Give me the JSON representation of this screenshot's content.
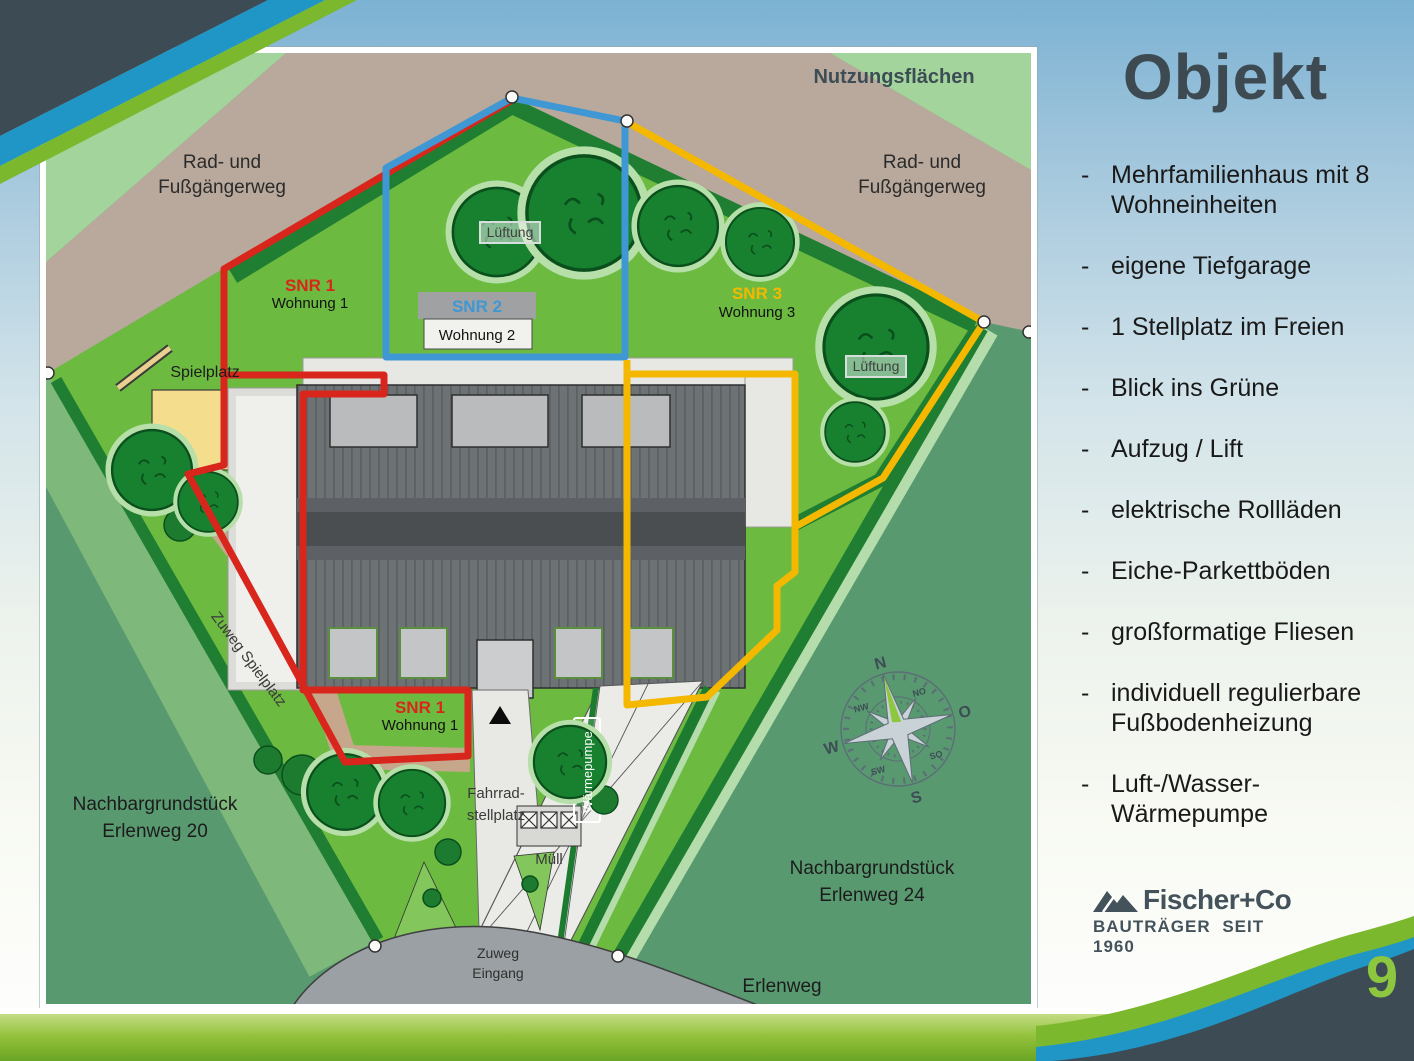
{
  "colors": {
    "red": "#d9261c",
    "blue": "#3f97d3",
    "yellow": "#f4b800",
    "slate": "#3c4b54",
    "accent_green": "#8dc63f",
    "band_green": "#7cb82e",
    "stripe_blue": "#1f96c5"
  },
  "slide": {
    "page_number": "9"
  },
  "sidebar": {
    "title": "Objekt",
    "bullet_marker": "-",
    "bullets": [
      {
        "text": "Mehrfamilienhaus mit 8 Wohneinheiten"
      },
      {
        "text": "eigene Tiefgarage"
      },
      {
        "text": "1 Stellplatz im Freien"
      },
      {
        "text": "Blick ins Grüne"
      },
      {
        "text": "Aufzug / Lift"
      },
      {
        "text": "elektrische Rollläden"
      },
      {
        "text": "Eiche-Parkettböden"
      },
      {
        "text": "großformatige Fliesen"
      },
      {
        "text": "individuell regulierbare Fußbodenheizung"
      },
      {
        "text": "Luft-/Wasser-\nWärmepumpe"
      }
    ]
  },
  "logo": {
    "name": "Fischer+Co",
    "tagline": "BAUTRÄGER SEIT 1960"
  },
  "map": {
    "title": "Nutzungsflächen",
    "path_label_line1": "Rad- und",
    "path_label_line2": "Fußgängerweg",
    "units": {
      "snr1": "SNR 1",
      "snr1_sub": "Wohnung 1",
      "snr2": "SNR 2",
      "snr2_sub": "Wohnung 2",
      "snr3": "SNR 3",
      "snr3_sub": "Wohnung 3"
    },
    "labels": {
      "lueftung": "Lüftung",
      "spielplatz": "Spielplatz",
      "zuweg_spielplatz": "Zuweg Spielplatz",
      "waermepumpe": "Wärmepumpe",
      "fahrrad_line1": "Fahrrad-",
      "fahrrad_line2": "stellplatz",
      "muell": "Müll",
      "zuweg_line1": "Zuweg",
      "zuweg_line2": "Eingang",
      "neighbor20_line1": "Nachbargrundstück",
      "neighbor20_line2": "Erlenweg 20",
      "neighbor24_line1": "Nachbargrundstück",
      "neighbor24_line2": "Erlenweg 24",
      "street": "Erlenweg"
    },
    "compass": {
      "n": "N",
      "o": "O",
      "s": "S",
      "w": "W",
      "no": "NO",
      "so": "SO",
      "sw": "SW",
      "nw": "NW"
    }
  }
}
